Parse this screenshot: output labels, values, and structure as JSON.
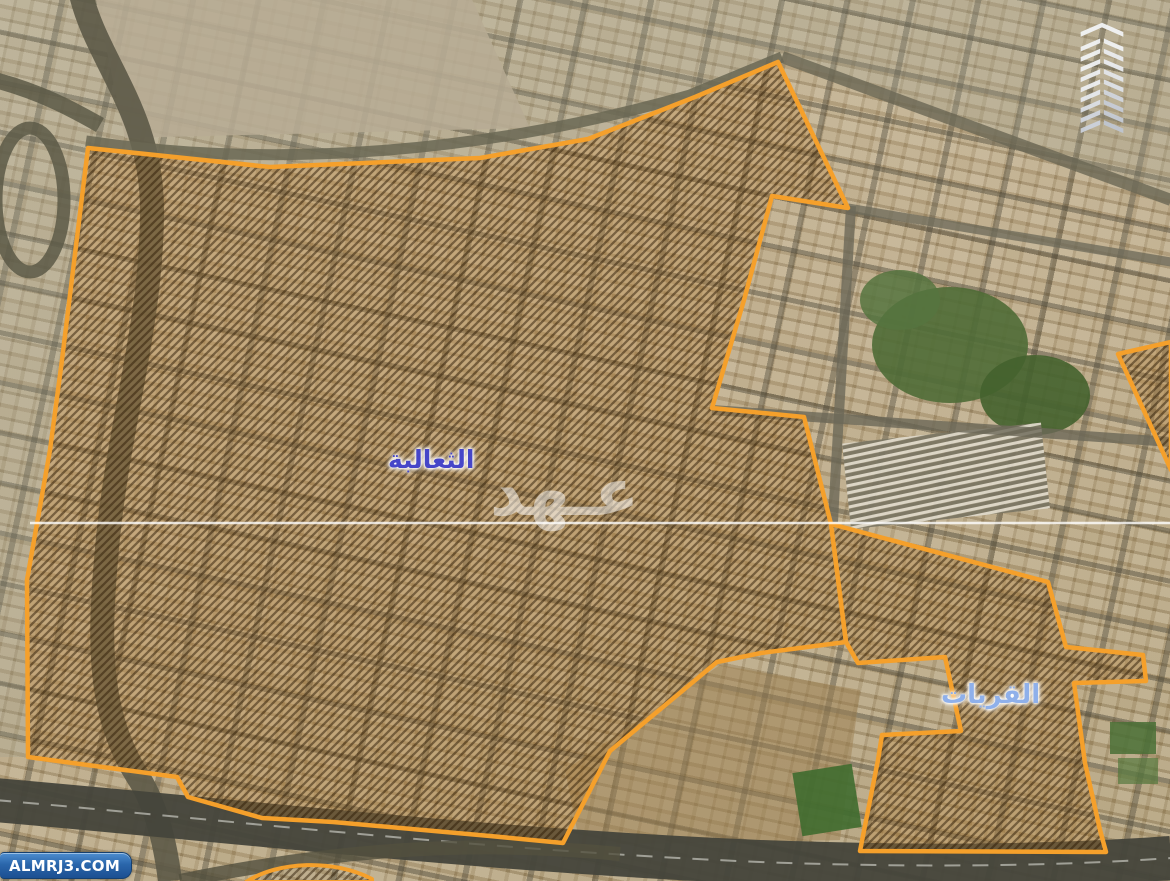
{
  "map": {
    "district_labels": [
      {
        "id": "thaalibah",
        "text": "الثعالبة"
      },
      {
        "id": "quraiyat",
        "text": "القريات"
      }
    ],
    "watermark": {
      "text": "عـهد"
    },
    "source_badge": {
      "text": "ALMRJ3.COM"
    },
    "icons": [
      {
        "name": "tower-logo-icon"
      }
    ]
  },
  "colors": {
    "boundary-orange": "#F5A02B",
    "hatch-dark": "#2E1C06",
    "label-primary-blue": "#4646C8",
    "label-secondary-blue": "#8FB0EA",
    "badge-blue": "#2A66AB",
    "watermark-white": "#FFFFFF"
  }
}
